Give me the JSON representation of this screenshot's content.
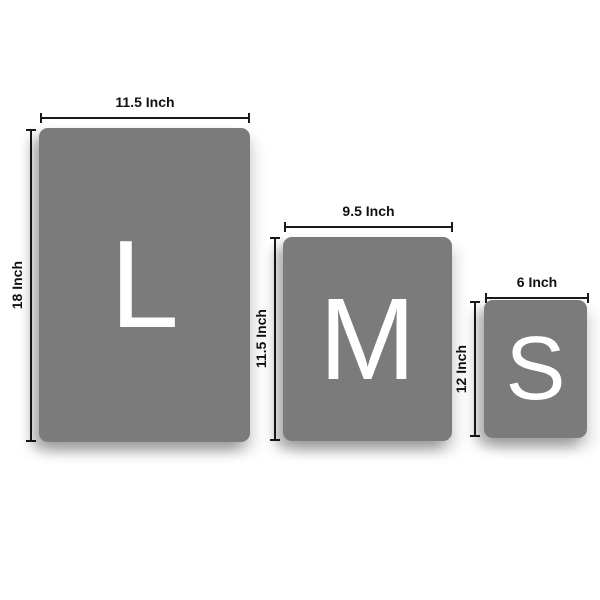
{
  "colors": {
    "background": "#ffffff",
    "panel_gray": "#7b7b7b",
    "letter_white": "#ffffff",
    "dimension_line": "#1a1a1a",
    "label_text": "#111111"
  },
  "sizes": [
    {
      "id": "large",
      "letter": "L",
      "width_label": "11.5 Inch",
      "height_label": "18 Inch",
      "width_inches": 11.5,
      "height_inches": 18
    },
    {
      "id": "medium",
      "letter": "M",
      "width_label": "9.5 Inch",
      "height_label": "11.5 Inch",
      "width_inches": 9.5,
      "height_inches": 11.5
    },
    {
      "id": "small",
      "letter": "S",
      "width_label": "6 Inch",
      "height_label": "12 Inch",
      "width_inches": 6,
      "height_inches": 12
    }
  ]
}
